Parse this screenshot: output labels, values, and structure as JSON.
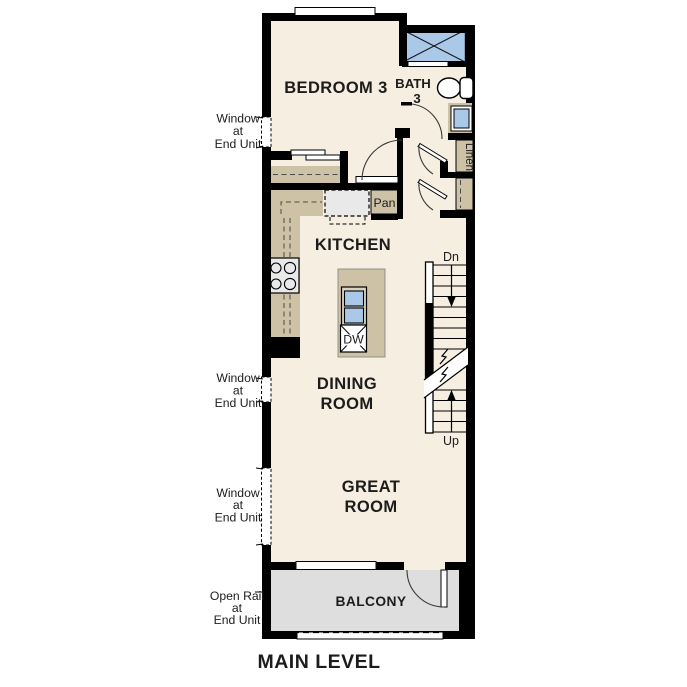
{
  "title": "MAIN LEVEL",
  "rooms": {
    "bedroom": "BEDROOM 3",
    "bath_line1": "BATH",
    "bath_line2": "3",
    "kitchen": "KITCHEN",
    "dining_line1": "DINING",
    "dining_line2": "ROOM",
    "great_line1": "GREAT",
    "great_line2": "ROOM",
    "balcony": "BALCONY"
  },
  "labels": {
    "pantry": "Pan",
    "dishwasher": "DW",
    "linen": "Linen",
    "stairs_down": "Dn",
    "stairs_up": "Up"
  },
  "annotations": {
    "window_l1": "Window",
    "window_l2": "at",
    "window_l3": "End Unit",
    "openrail_l1": "Open Rail",
    "openrail_l2": "at",
    "openrail_l3": "End Unit"
  },
  "colors": {
    "wall": "#000000",
    "floor": "#f5eee1",
    "cabinet": "#cdc1a6",
    "appliance": "#e9e9e9",
    "balcony_floor": "#dedede",
    "water_blue": "#aac9e9"
  }
}
